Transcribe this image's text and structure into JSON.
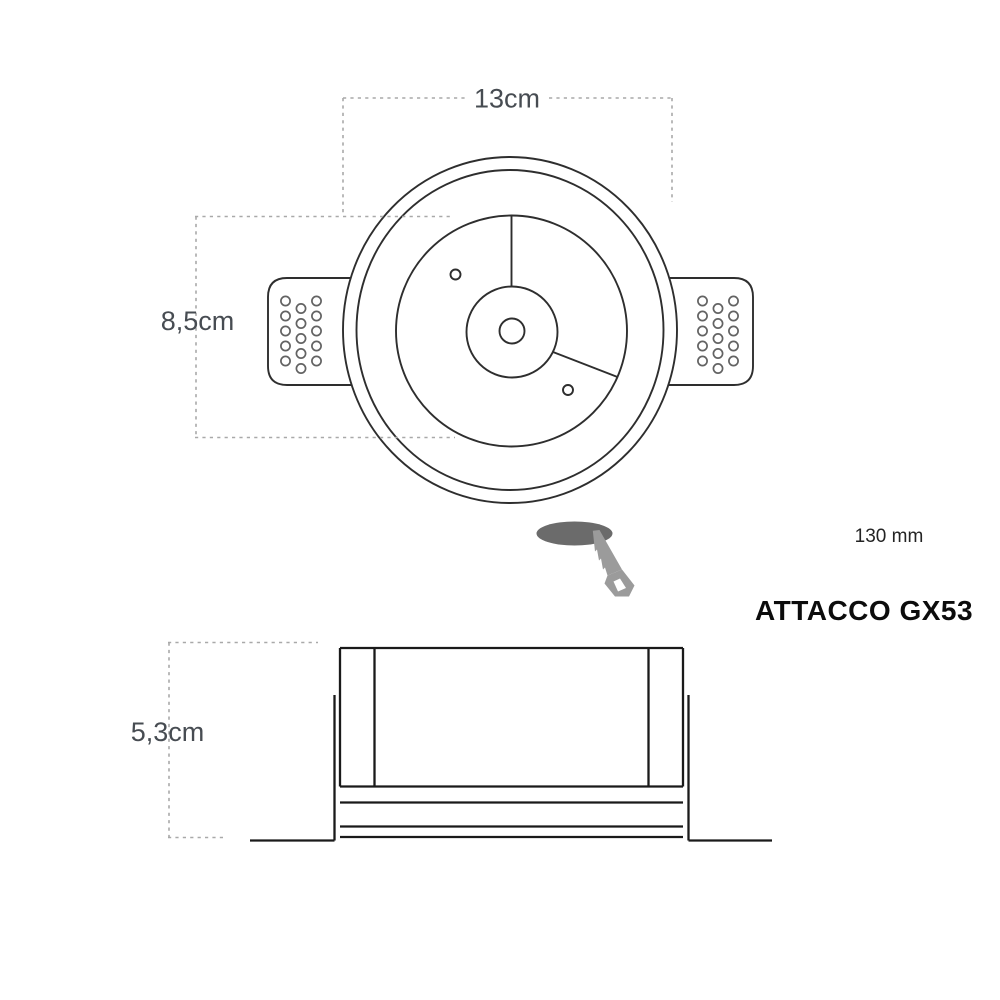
{
  "top_view": {
    "width_label": "13cm",
    "height_label": "8,5cm"
  },
  "side_view": {
    "height_label": "5,3cm"
  },
  "cutout": {
    "diameter_label": "130 mm"
  },
  "socket": {
    "label": "ATTACCO GX53"
  },
  "colors": {
    "line": "#2e2e2e",
    "side_line": "#1a1a1a",
    "dash": "#a9a9a9",
    "dim_text": "#474c52",
    "label_text": "#0c0c0c",
    "saw": "#9b9b9b",
    "hole": "#6b6b6b",
    "bg": "#ffffff"
  }
}
